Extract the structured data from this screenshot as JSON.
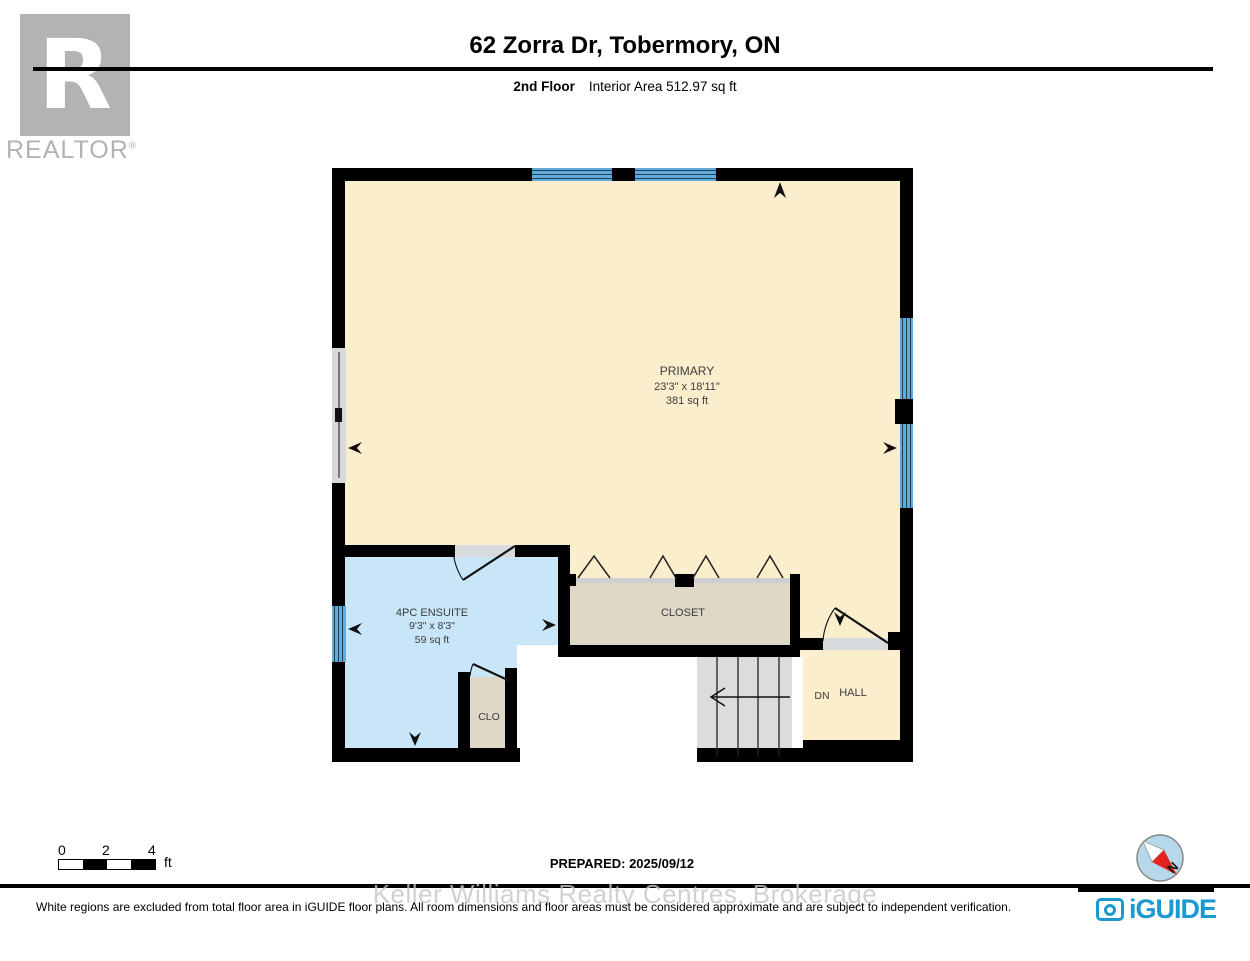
{
  "header": {
    "title": "62 Zorra Dr, Tobermory, ON",
    "floor_label": "2nd Floor",
    "area_label": "Interior Area 512.97 sq ft"
  },
  "brand": {
    "realtor_letter": "R",
    "realtor_text": "REALTOR",
    "realtor_reg": "®",
    "iguide": "iGUIDE"
  },
  "rooms": {
    "primary": {
      "name": "PRIMARY",
      "dims": "23'3\" x 18'11\"",
      "area": "381 sq ft"
    },
    "ensuite": {
      "name": "4PC ENSUITE",
      "dims": "9'3\" x 8'3\"",
      "area": "59 sq ft"
    },
    "closet": {
      "name": "CLOSET"
    },
    "clo": {
      "name": "CLO"
    },
    "hall": {
      "name": "HALL",
      "dn": "DN"
    }
  },
  "scale": {
    "t0": "0",
    "t2": "2",
    "t4": "4",
    "unit": "ft"
  },
  "compass": {
    "n": "N"
  },
  "footer": {
    "prepared": "PREPARED: 2025/09/12",
    "watermark": "Keller Williams Realty Centres, Brokerage",
    "disclaimer": "White regions are excluded from total floor area in iGUIDE floor plans. All room dimensions and floor areas must be considered approximate and are subject to independent verification."
  },
  "colors": {
    "cream": "#fbeecd",
    "ensuite": "#c9e5f8",
    "tan": "#dfd8c6",
    "winblue": "#5fabdc",
    "winline": "#1d4058",
    "stair": "#dcdcdc",
    "thresh": "#d8dbde",
    "grayseg": "#d9d9d9",
    "wall": "#000000",
    "iguide": "#1b9ad2",
    "logogray": "#b3b3b3",
    "wmark": "#c6c6c6",
    "ink": "#3d3d3d",
    "compassfill": "#b5d8eb",
    "compassred": "#e42320"
  }
}
